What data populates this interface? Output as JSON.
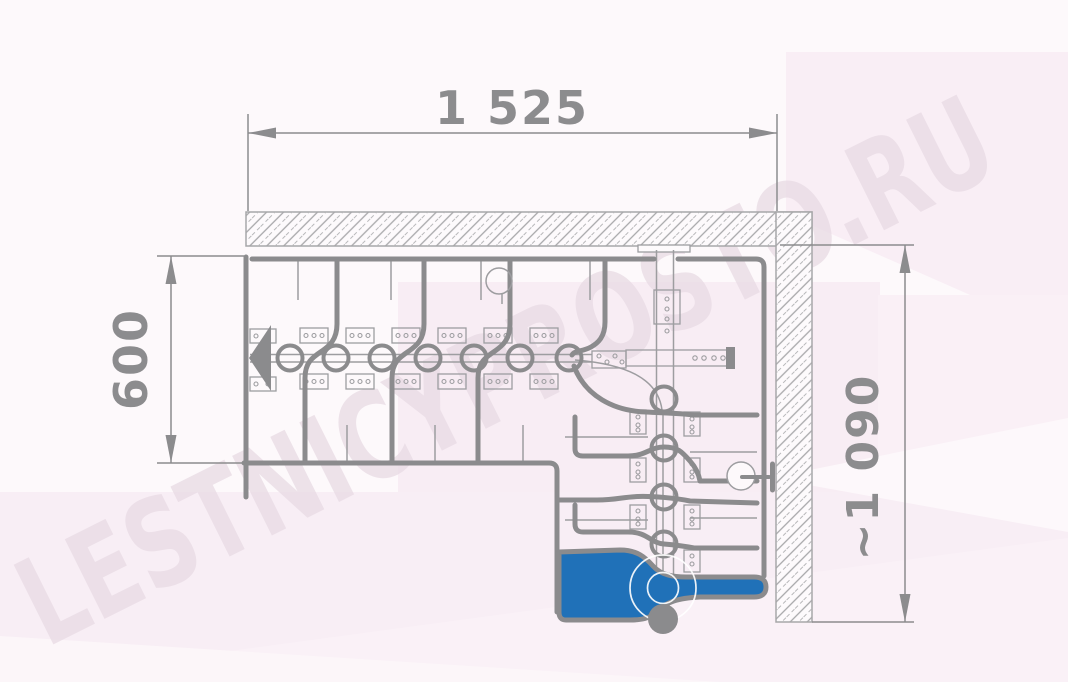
{
  "title": "L-shaped modular staircase plan drawing",
  "watermark": {
    "text": "LESTNICYPROSTO.RU"
  },
  "dimensions": {
    "top": {
      "label": "1 525"
    },
    "left": {
      "label": "600"
    },
    "right": {
      "label": "~1 090"
    }
  },
  "drawing": {
    "view": "plan (top) view",
    "walls": [
      "hatched wall along top",
      "hatched wall along right side"
    ],
    "straight_flight_modules": 7,
    "turn_flight_modules": 4,
    "winder_treads": 4,
    "bottom_step": "highlighted blue with round support post",
    "walk_direction_arrow": "pointing left"
  },
  "colors": {
    "line": "#8b8b8d",
    "lineLight": "#9d9da0",
    "dimText": "#8c8c8e",
    "blue": "#2071b8",
    "wallHatch": "#a7a7a9",
    "bgBase": "#fdf9fb",
    "pink": "#f8edf4",
    "pinkLight": "#faf1f7",
    "watermark": "#e9dce5"
  }
}
